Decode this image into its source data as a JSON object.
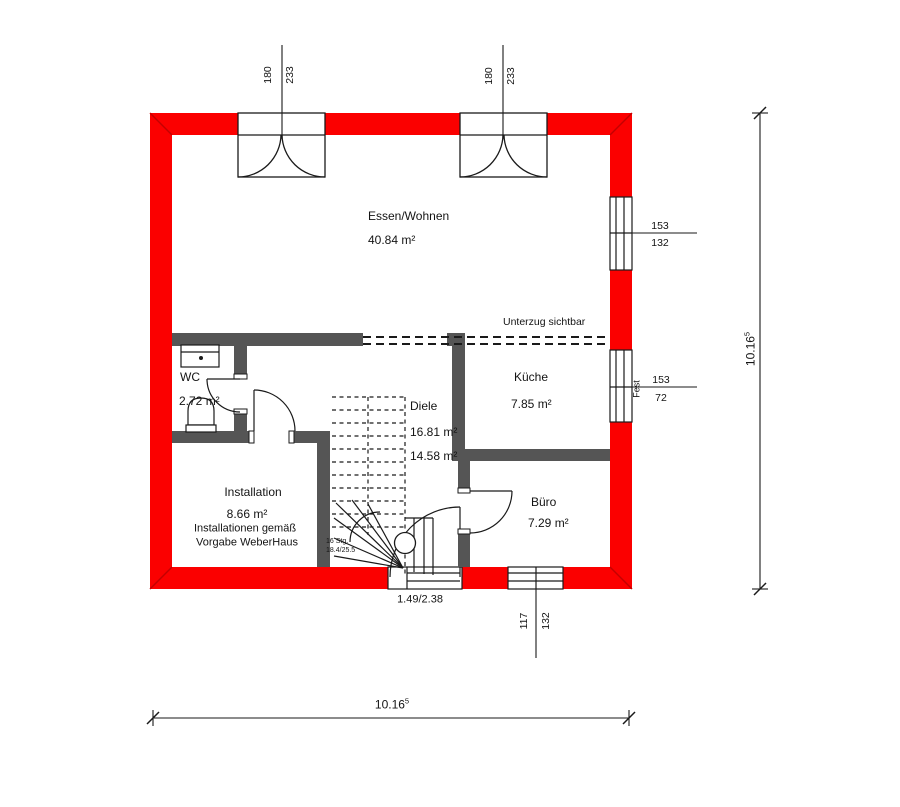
{
  "rooms": {
    "essen_wohnen": {
      "name": "Essen/Wohnen",
      "area": "40.84 m²"
    },
    "wc": {
      "name": "WC",
      "area": "2.72 m²"
    },
    "diele": {
      "name": "Diele",
      "area_1": "16.81 m²",
      "area_2": "14.58 m²"
    },
    "kueche": {
      "name": "Küche",
      "area": "7.85 m²"
    },
    "installation": {
      "name": "Installation",
      "area": "8.66 m²",
      "note_line_1": "Installationen gemäß",
      "note_line_2": "Vorgabe WeberHaus"
    },
    "buero": {
      "name": "Büro",
      "area": "7.29 m²"
    }
  },
  "annotations": {
    "beam": "Unterzug sichtbar",
    "entry_door_size": "1.49/2.38",
    "stair_steps": "16 Stg.",
    "stair_ratio": "18.4/25.5",
    "fixed_glazing": "Fest"
  },
  "dimensions": {
    "door_top_left": {
      "width": "180",
      "height": "233"
    },
    "door_top_right": {
      "width": "180",
      "height": "233"
    },
    "window_right_upper": {
      "width": "153",
      "height": "132"
    },
    "window_right_lower": {
      "width": "153",
      "height": "72"
    },
    "window_bottom": {
      "width": "117",
      "height": "132"
    },
    "total_width": {
      "value": "10.16",
      "sup": "5"
    },
    "total_height": {
      "value": "10.16",
      "sup": "5"
    }
  },
  "colors": {
    "exterior_wall": "#fb0000",
    "exterior_wall_miter": "#c40000",
    "interior_wall": "#555555",
    "line": "#1a1a1a"
  }
}
